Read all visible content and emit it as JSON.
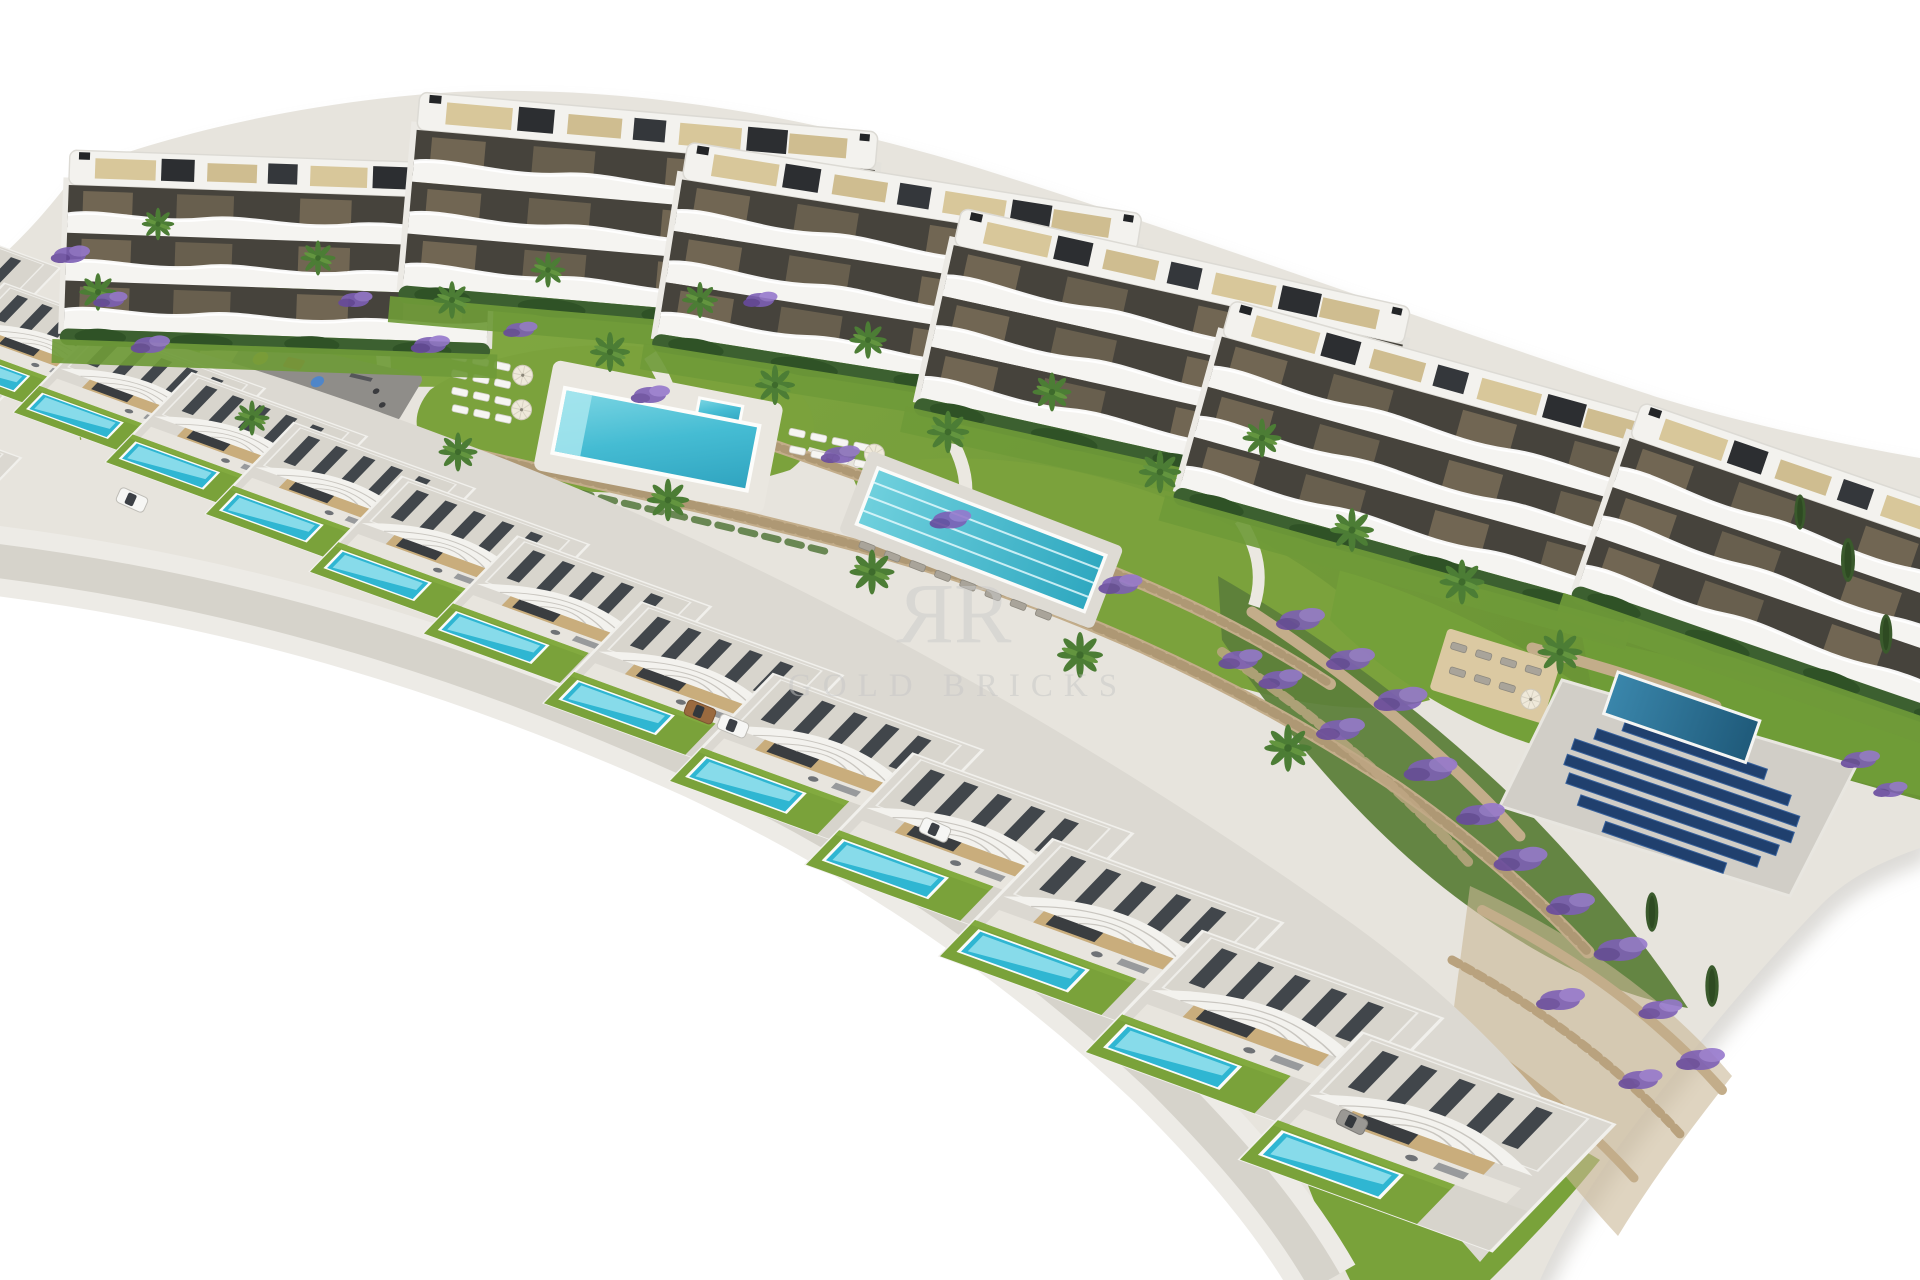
{
  "scene": {
    "type": "3d-architectural-aerial-render",
    "description": "Aerial render of a hillside residential development: a curved row of white apartment buildings with balconies and rooftop terraces, communal gardens with palm trees and purple flower beds, a leisure pool and a lap pool with sun loungers, a playground, stone retaining walls, a solar panel array, and a long stepped row of modern villas each with a private pool",
    "background_color": "#ffffff"
  },
  "watermark": {
    "logo_letter": "R",
    "text": "GOLD BRICKS",
    "color": "#c6c6c6"
  },
  "development": {
    "apartment_buildings": 6,
    "apartment_floors_visible": 4,
    "villas_visible": 15,
    "villa_private_pools": 12,
    "amenities": {
      "communal_leisure_pool": 1,
      "communal_lap_pool": 1,
      "lap_pool_lane_lines": 3,
      "apartment_block_pool": 1,
      "playground": true,
      "sun_loungers": true,
      "parasols": true,
      "solar_panel_rows": 7
    },
    "landscaping": [
      "palm trees",
      "cypress trees",
      "purple flower beds",
      "stone retaining walls",
      "lawns",
      "hedges"
    ],
    "vehicles_visible": 5
  },
  "palette": {
    "paving": "#e7e4dd",
    "road": "#d6d3cb",
    "facade_white": "#f5f4f0",
    "window_void": "#46433c",
    "rooftop_deck_beige": "#d8c79a",
    "pergola_slats": "#41464b",
    "villa_roof": "#d8d5cd",
    "villa_wall_beige": "#c9ad7c",
    "lawn": "#7ba23c",
    "hedge": "#3c6030",
    "leisure_pool": "#45bcd3",
    "lap_pool": "#4fb9cc",
    "apartment_pool_deep": "#2b7396",
    "stone_wall": "#c3ad8a",
    "flowers_purple": "#7d5fb5",
    "solar_panel": "#20406e",
    "playground_surface": "#8f8d89",
    "sand": "#d9c9a0"
  }
}
